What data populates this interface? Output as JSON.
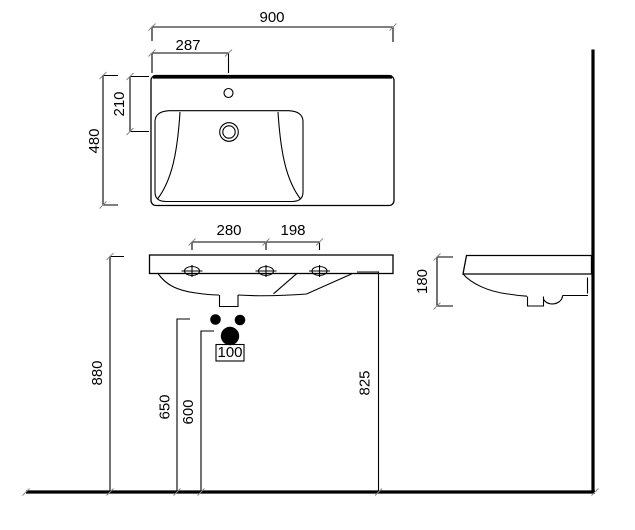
{
  "dimensions": {
    "top_view": {
      "overall_width": "900",
      "tap_hole_offset": "287",
      "overall_depth": "480",
      "drain_center_offset": "210"
    },
    "front_view": {
      "fixing_span_left": "280",
      "fixing_span_right": "198",
      "overall_height": "880",
      "supply_height": "650",
      "waste_height": "600",
      "right_rim_height": "825",
      "waste_hole_label": "100"
    },
    "side_view": {
      "apron_height": "180"
    }
  }
}
